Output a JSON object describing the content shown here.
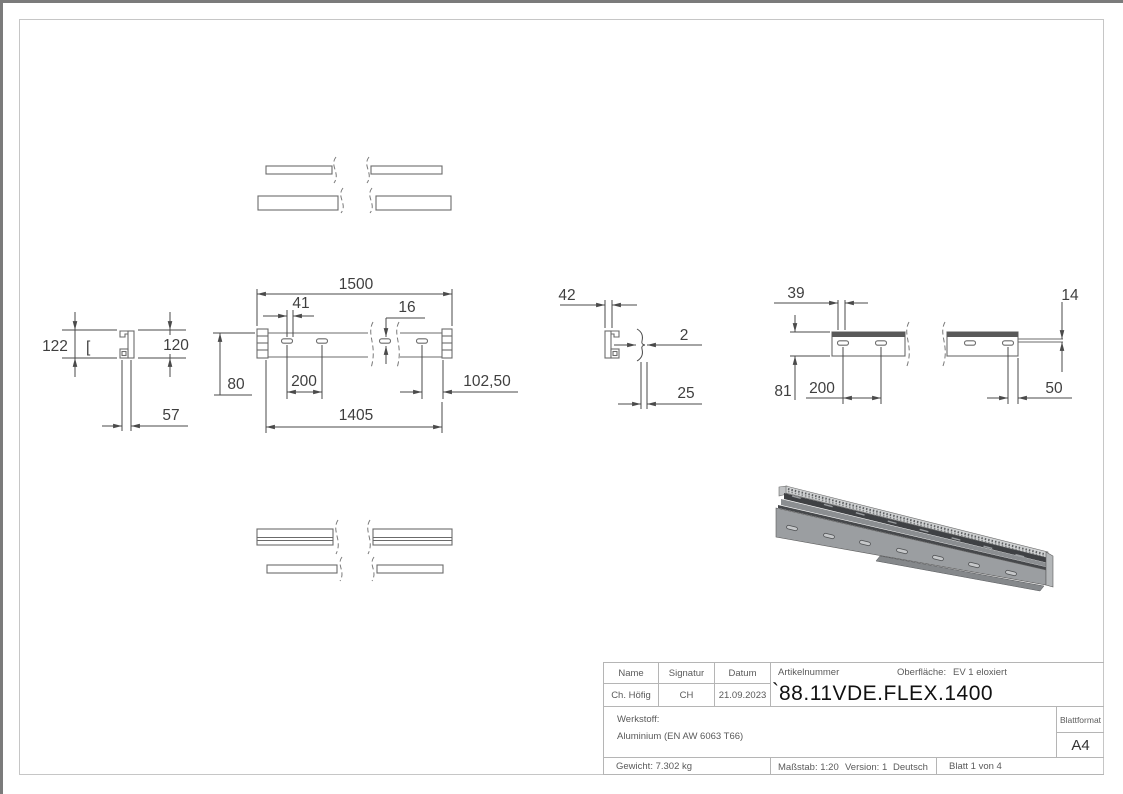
{
  "drawing": {
    "dims": {
      "total_length": "1500",
      "first_hole_offset": "41",
      "slot_size": "16",
      "section_width_mid": "42",
      "back_hole_offset": "39",
      "lip": "14",
      "height_outer": "122",
      "height_inner": "120",
      "base": "80",
      "hole_pitch_front": "200",
      "end_offset": "102,50",
      "inner_length": "1405",
      "depth": "57",
      "wall_thickness": "2",
      "gap": "25",
      "back_height": "81",
      "hole_pitch_back": "200",
      "back_end_offset": "50"
    },
    "marks": {
      "bracket": "["
    }
  },
  "title_block": {
    "headers": {
      "name": "Name",
      "signature": "Signatur",
      "date": "Datum"
    },
    "values": {
      "name": "Ch. Höfig",
      "signature": "CH",
      "date": "21.09.2023"
    },
    "article_label": "Artikelnummer",
    "surface_label": "Oberfläche:",
    "surface_value": "EV 1 eloxiert",
    "article_mark": "`",
    "article_number": "88.11VDE.FLEX.1400",
    "material_label": "Werkstoff:",
    "material_value": "Aluminium (EN AW 6063 T66)",
    "format_label": "Blattformat",
    "format_value": "A4",
    "weight": "Gewicht: 7.302 kg",
    "scale": "Maßstab: 1:20",
    "version": "Version: 1",
    "language": "Deutsch",
    "sheet": "Blatt 1 von 4"
  }
}
